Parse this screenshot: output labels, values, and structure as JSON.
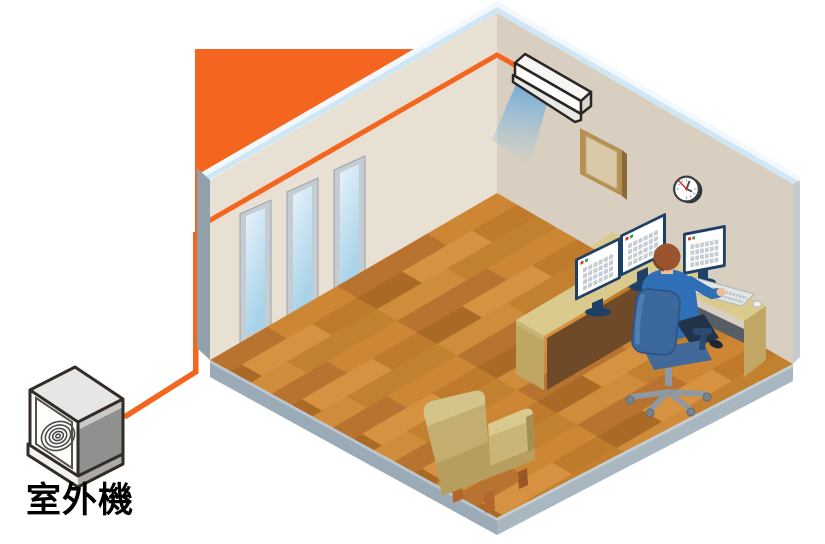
{
  "scene": {
    "title": "air-conditioner-installation-room-illustration",
    "outdoor_unit_label": "室外機",
    "colors": {
      "accent_orange_pipe": "#f4661f",
      "wall_left": "#e8e0d2",
      "wall_right": "#d9cfc0",
      "ceiling_edge_blue": "#cfe6f4",
      "ceiling_edge_white": "#f2f8fc",
      "wall_end_gray": "#92a0ab",
      "floor_base": "#c8812f",
      "floor_slab_gray": "#9aaab6",
      "desk_tan": "#dbca8e",
      "monitor_navy": "#1d4166",
      "screen_white": "#ffffff",
      "chair_blue": "#3a689c",
      "shirt_blue": "#2f6fb6",
      "hair_brown": "#9a552f",
      "armchair_tan": "#c3ad6f",
      "window_glass": "#bfe0f0",
      "ac_unit_white": "#ffffff",
      "airflow_blue": "#6ea9d7",
      "outline_dark": "#332c26",
      "label_black": "#000000"
    },
    "objects": [
      "outdoor-unit",
      "refrigerant-pipe",
      "air-conditioner-indoor-unit",
      "airflow",
      "window",
      "picture-frame",
      "wall-clock",
      "desk",
      "monitor",
      "keyboard",
      "mouse",
      "office-worker",
      "office-chair",
      "armchair",
      "wood-floor"
    ]
  }
}
